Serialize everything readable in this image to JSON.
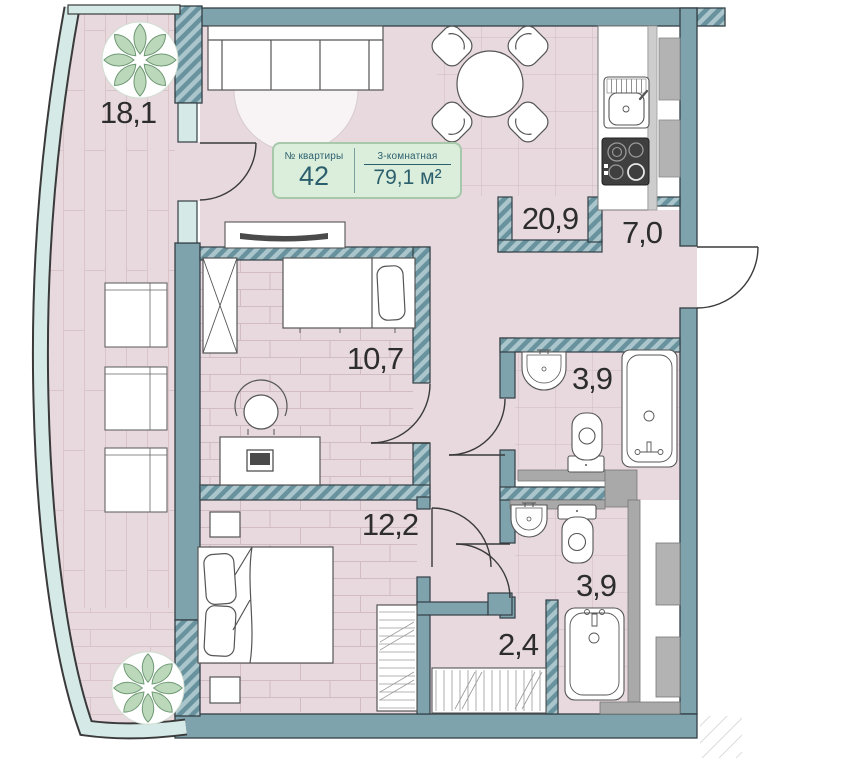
{
  "badge": {
    "number_label": "№ квартиры",
    "number": "42",
    "type_label": "3-комнатная",
    "area_label": "79,1 м²"
  },
  "rooms": {
    "balcony": "18,1",
    "living_kitchen": "20,9",
    "hallway": "7,0",
    "bedroom_small": "10,7",
    "bathroom_upper": "3,9",
    "bedroom_master": "12,2",
    "bathroom_lower": "3,9",
    "closet": "2,4"
  },
  "colors": {
    "wall": "#7fa3ad",
    "wall_hatch_dark": "#68929d",
    "wall_hatch_light": "#aac5cb",
    "floor": "#e7d9de",
    "glass": "#d5e9e7",
    "grey_wall": "#a9a9a9",
    "badge_bg": "#dbeedb",
    "badge_border": "#a8c8ab",
    "badge_text": "#2c5f6e",
    "plant": "#bcd8ba"
  }
}
